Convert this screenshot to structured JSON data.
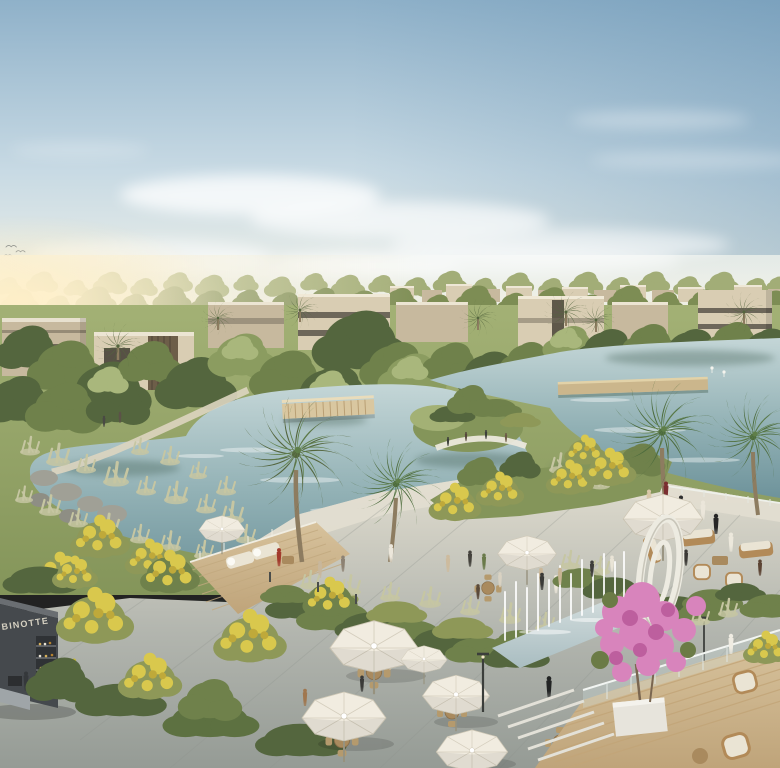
{
  "scene": {
    "alt": "Aerial architectural rendering of a lagoon waterfront community: winding blue-green lakes with a planted island and curved viewing deck, rows of beige modern villas among dense trees on the horizon, palm trees, yellow-flowering trees, a sunlit promenade with white cafe umbrellas and wooden tables, a dark coffee kiosk, a white elliptical sculpture, fountain jets beside a reflecting pool, a pink bougainvillea in a white planter on a timber deck, rattan lounge furniture and strolling people.",
    "kiosk_sign": "BINOTTE"
  },
  "palette": {
    "sky-top": "#8fb1c9",
    "sky-mid": "#c8dae4",
    "sky-low": "#ecefe8",
    "horizon-cream": "#f4efdd",
    "glow": "#ffefc8",
    "cloud": "#ffffff",
    "treeline-back": "#a2ad77",
    "treeline-front": "#7d8d54",
    "tree-dark": "#54663e",
    "tree-mid": "#6f814b",
    "tree-light": "#8b9c60",
    "tree-pale": "#a9b77c",
    "olive": "#8e9858",
    "palm-green": "#4c6b3d",
    "palm-light": "#5f7f49",
    "palm-trunk": "#8d7c60",
    "villa-light": "#d9cdb3",
    "villa-mid": "#c7b99e",
    "villa-dark": "#746c5b",
    "villa-window": "#575145",
    "water-top": "#c4d6d7",
    "water-mid": "#92b1b5",
    "water-deep": "#6e939b",
    "reflection": "#3f5d51",
    "grass-light": "#a3b175",
    "grass-mid": "#84955a",
    "grass-dark": "#5d7141",
    "sedge": "#c6c6a2",
    "rock": "#a0a096",
    "yellow": "#d9c84d",
    "yellow-deep": "#bfa93a",
    "walk-light": "#e2ded0",
    "walk-mid": "#cfccc0",
    "plaza": "#b2b5ae",
    "plaza-dark": "#959b95",
    "deck-wood": "#d7c29c",
    "deck-line": "#bfa47a",
    "umbrella": "#f1ece0",
    "umb-line": "#cfc8b6",
    "pole": "#97927e",
    "wood": "#a98a5e",
    "wood2": "#b59a6d",
    "wicker": "#b28a58",
    "cushion": "#eae4d4",
    "kiosk": "#45494d",
    "kiosk-dark": "#2f3235",
    "sign": "#d6d1c2",
    "sculpture": "#edebe1",
    "pink": "#d884bc",
    "pink-deep": "#bd5f9e",
    "planter": "#e7e4dc",
    "glass": "#cfe0e0",
    "lamp": "#3b3e3b",
    "pool-top": "#d3dddd",
    "pool-bottom": "#a9bdc1"
  }
}
